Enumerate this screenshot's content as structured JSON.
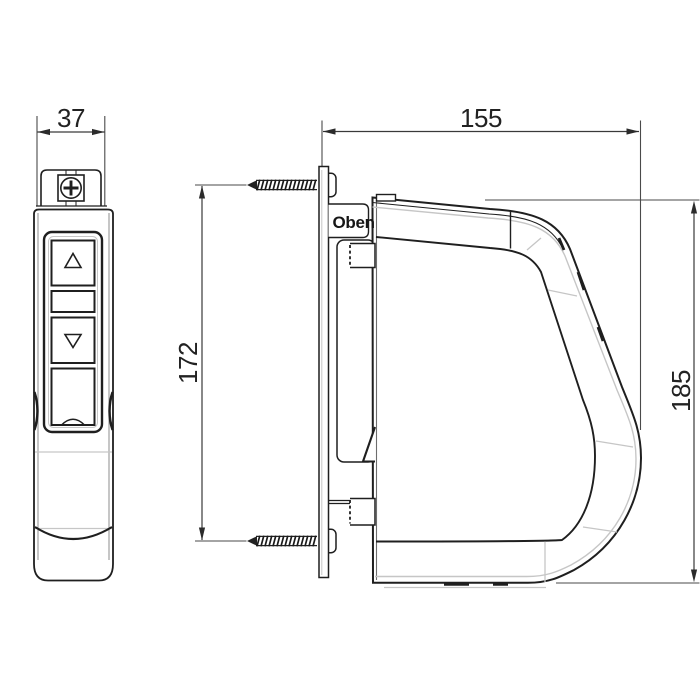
{
  "drawing": {
    "dimensions": {
      "remote_width": "37",
      "winder_width": "155",
      "screw_spacing": "172",
      "winder_height": "185"
    },
    "labels": {
      "orientation_top": "Oben"
    },
    "colors": {
      "line": "#1f1f1f",
      "dimension_line": "#3a3a3a",
      "light_line": "#c6c6c6",
      "background": "#ffffff"
    }
  }
}
